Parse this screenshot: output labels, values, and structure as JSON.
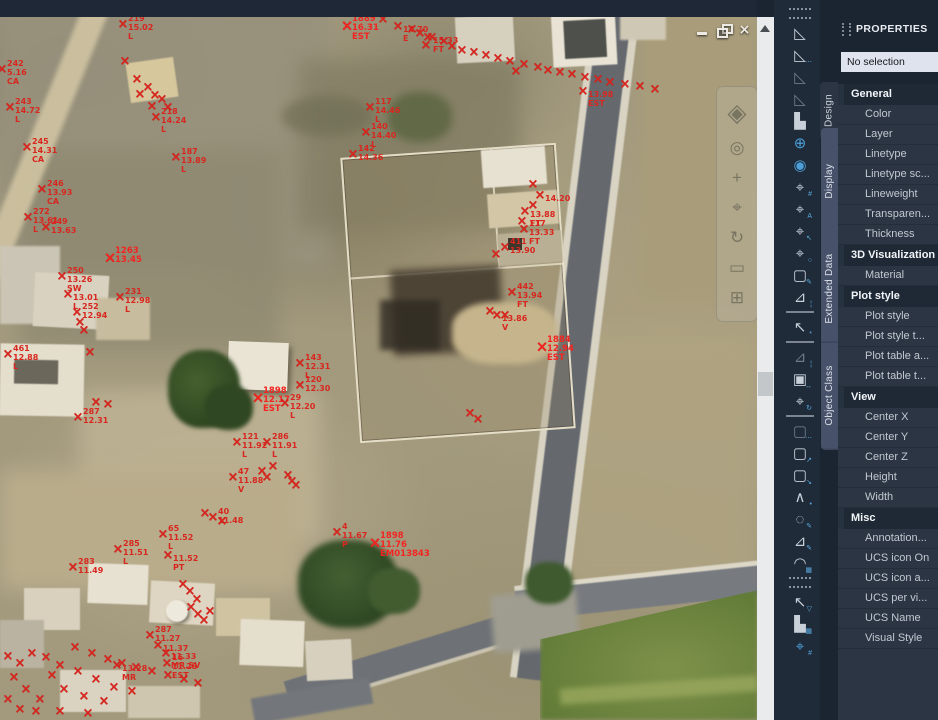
{
  "window": {
    "controls": [
      {
        "name": "minimize"
      },
      {
        "name": "restore"
      },
      {
        "name": "close"
      }
    ]
  },
  "nav_bar": {
    "icons": [
      {
        "name": "viewcube-icon",
        "glyph": "◈"
      },
      {
        "name": "steering-wheel-icon",
        "glyph": "◎"
      },
      {
        "name": "pan-icon",
        "glyph": "+"
      },
      {
        "name": "zoom-icon",
        "glyph": "⌖"
      },
      {
        "name": "orbit-icon",
        "glyph": "↻"
      },
      {
        "name": "showmotion-icon",
        "glyph": "▭"
      },
      {
        "name": "layout-grid-icon",
        "glyph": "⊞"
      }
    ]
  },
  "side_toolbar": {
    "items": [
      {
        "type": "grip"
      },
      {
        "name": "surface-triangle-icon",
        "glyph": "◺"
      },
      {
        "name": "surface-dashed-icon",
        "glyph": "◺",
        "sub": "⋯"
      },
      {
        "name": "surface-dim-icon",
        "glyph": "◺",
        "c": "dim"
      },
      {
        "name": "surface-outline-icon",
        "glyph": "◺",
        "c": "dim"
      },
      {
        "name": "blocks-icon",
        "glyph": "▙"
      },
      {
        "name": "globe-grid-icon",
        "glyph": "⊕",
        "c": "blue"
      },
      {
        "name": "blue-sphere-icon",
        "glyph": "◉",
        "c": "blue"
      },
      {
        "name": "point-hash-icon",
        "glyph": "⌖",
        "sub": "#"
      },
      {
        "name": "point-label-icon",
        "glyph": "⌖",
        "sub": "A"
      },
      {
        "name": "point-cursor-icon",
        "glyph": "⌖",
        "sub": "↖"
      },
      {
        "name": "point-zoom-icon",
        "glyph": "⌖",
        "sub": "○"
      },
      {
        "name": "edit-box-icon",
        "glyph": "▢",
        "sub": "✎"
      },
      {
        "name": "profile-dashed-icon",
        "glyph": "⊿",
        "sub": "¦"
      },
      {
        "type": "sep"
      },
      {
        "name": "selection-cursor-icon",
        "glyph": "↖",
        "sub": "*"
      },
      {
        "type": "sep"
      },
      {
        "name": "dashed-view-icon",
        "glyph": "⊿",
        "c": "dim",
        "sub": "¦"
      },
      {
        "name": "box-3d-icon",
        "glyph": "▣",
        "sub": "↔"
      },
      {
        "name": "point-rotate-icon",
        "glyph": "⌖",
        "sub": "↻"
      },
      {
        "type": "sep"
      },
      {
        "name": "dashed-rect-icon",
        "glyph": "▢",
        "c": "dim",
        "sub": "⋯"
      },
      {
        "name": "stretch-rect-icon",
        "glyph": "▢",
        "sub": "↗"
      },
      {
        "name": "scale-rect-icon",
        "glyph": "▢",
        "sub": "↘"
      },
      {
        "name": "polyline-nodes-icon",
        "glyph": "∧",
        "sub": "•"
      },
      {
        "name": "circle-modify-icon",
        "glyph": "◌",
        "sub": "✎"
      },
      {
        "name": "triangle-modify-icon",
        "glyph": "⊿",
        "sub": "✎"
      },
      {
        "name": "arc-calc-icon",
        "glyph": "◠",
        "sub": "▦"
      },
      {
        "type": "grip"
      },
      {
        "name": "filter-cursor-icon",
        "glyph": "↖",
        "sub": "▽"
      },
      {
        "name": "blocks-grid-icon",
        "glyph": "▙",
        "sub": "▦"
      },
      {
        "name": "point-filter-icon",
        "glyph": "⌖",
        "c": "blue",
        "sub": "#"
      }
    ]
  },
  "properties_panel": {
    "title": "PROPERTIES",
    "selection": "No selection",
    "tabs": [
      {
        "label": "Design",
        "active": true
      },
      {
        "label": "Display",
        "active": false
      },
      {
        "label": "Extended Data",
        "active": false
      },
      {
        "label": "Object Class",
        "active": false
      }
    ],
    "sections": [
      {
        "header": "General",
        "rows": [
          "Color",
          "Layer",
          "Linetype",
          "Linetype sc...",
          "Lineweight",
          "Transparen...",
          "Thickness"
        ]
      },
      {
        "header": "3D Visualization",
        "rows": [
          "Material"
        ]
      },
      {
        "header": "Plot style",
        "rows": [
          "Plot style",
          "Plot style t...",
          "Plot table a...",
          "Plot table t..."
        ]
      },
      {
        "header": "View",
        "rows": [
          "Center X",
          "Center Y",
          "Center Z",
          "Height",
          "Width"
        ]
      },
      {
        "header": "Misc",
        "rows": [
          "Annotation...",
          "UCS icon On",
          "UCS icon a...",
          "UCS per vi...",
          "UCS Name",
          "Visual Style"
        ]
      }
    ]
  },
  "map": {
    "x_glyph": "×",
    "marker_color": "#da241e",
    "bold_color": "#f42420",
    "markers": [
      {
        "x": 123,
        "y": 25,
        "t": [
          "219",
          "15.02",
          "L"
        ]
      },
      {
        "x": 347,
        "y": 26,
        "t": [
          "1889",
          "16.31",
          "EST"
        ],
        "b": 1
      },
      {
        "x": 398,
        "y": 27,
        "t": [
          "",
          "14.70",
          "E"
        ]
      },
      {
        "x": 428,
        "y": 38,
        "t": [
          "",
          "15.33",
          "FT"
        ]
      },
      {
        "x": 583,
        "y": 92,
        "t": [
          "",
          "13.98",
          "EST"
        ]
      },
      {
        "x": 2,
        "y": 70,
        "t": [
          "242",
          "5.16",
          "CA"
        ]
      },
      {
        "x": 10,
        "y": 108,
        "t": [
          "243",
          "14.72",
          "L"
        ]
      },
      {
        "x": 156,
        "y": 118,
        "t": [
          "218",
          "14.24",
          "L"
        ]
      },
      {
        "x": 27,
        "y": 148,
        "t": [
          "245",
          "14.31",
          "CA"
        ]
      },
      {
        "x": 176,
        "y": 158,
        "t": [
          "187",
          "13.89",
          "L"
        ]
      },
      {
        "x": 42,
        "y": 190,
        "t": [
          "246",
          "13.93",
          "CA"
        ]
      },
      {
        "x": 28,
        "y": 218,
        "t": [
          "272",
          "13.61",
          "L"
        ]
      },
      {
        "x": 46,
        "y": 228,
        "t": [
          "249",
          "13.63"
        ]
      },
      {
        "x": 110,
        "y": 258,
        "t": [
          "1263",
          "13.45"
        ],
        "b": 1
      },
      {
        "x": 62,
        "y": 277,
        "t": [
          "250",
          "13.26",
          "SW"
        ]
      },
      {
        "x": 68,
        "y": 295,
        "t": [
          "",
          "13.01",
          "L"
        ]
      },
      {
        "x": 120,
        "y": 298,
        "t": [
          "231",
          "12.98",
          "L"
        ]
      },
      {
        "x": 77,
        "y": 313,
        "t": [
          "252",
          "12.94"
        ]
      },
      {
        "x": 8,
        "y": 355,
        "t": [
          "461",
          "12.88",
          "L"
        ]
      },
      {
        "x": 78,
        "y": 418,
        "t": [
          "287",
          "12.31"
        ]
      },
      {
        "x": 370,
        "y": 108,
        "t": [
          "117",
          "14.46",
          "L"
        ]
      },
      {
        "x": 366,
        "y": 133,
        "t": [
          "140",
          "14.40",
          "L"
        ]
      },
      {
        "x": 353,
        "y": 155,
        "t": [
          "142",
          "14.36"
        ]
      },
      {
        "x": 540,
        "y": 196,
        "t": [
          "",
          "14.20"
        ]
      },
      {
        "x": 525,
        "y": 212,
        "t": [
          "",
          "13.88",
          "FT"
        ]
      },
      {
        "x": 524,
        "y": 230,
        "t": [
          "117",
          "13.33",
          "FT"
        ]
      },
      {
        "x": 505,
        "y": 248,
        "t": [
          "411",
          "13.90"
        ]
      },
      {
        "x": 512,
        "y": 293,
        "t": [
          "442",
          "13.94",
          "FT"
        ]
      },
      {
        "x": 497,
        "y": 316,
        "t": [
          "",
          "13.86",
          "V"
        ]
      },
      {
        "x": 542,
        "y": 347,
        "t": [
          "1884",
          "12.94",
          "EST"
        ],
        "b": 1
      },
      {
        "x": 300,
        "y": 364,
        "t": [
          "143",
          "12.31",
          "L"
        ]
      },
      {
        "x": 300,
        "y": 386,
        "t": [
          "120",
          "12.30"
        ]
      },
      {
        "x": 258,
        "y": 398,
        "t": [
          "1898",
          "12.17",
          "EST"
        ],
        "b": 1
      },
      {
        "x": 285,
        "y": 404,
        "t": [
          "29",
          "12.20",
          "L"
        ]
      },
      {
        "x": 237,
        "y": 443,
        "t": [
          "121",
          "11.92",
          "L"
        ]
      },
      {
        "x": 267,
        "y": 443,
        "t": [
          "286",
          "11.91",
          "L"
        ]
      },
      {
        "x": 233,
        "y": 478,
        "t": [
          "47",
          "11.88",
          "V"
        ]
      },
      {
        "x": 213,
        "y": 518,
        "t": [
          "40",
          "11.48"
        ]
      },
      {
        "x": 163,
        "y": 535,
        "t": [
          "65",
          "11.52",
          "L"
        ]
      },
      {
        "x": 118,
        "y": 550,
        "t": [
          "285",
          "11.51",
          "L"
        ]
      },
      {
        "x": 168,
        "y": 556,
        "t": [
          "",
          "11.52",
          "PT"
        ]
      },
      {
        "x": 73,
        "y": 568,
        "t": [
          "283",
          "11.49"
        ]
      },
      {
        "x": 337,
        "y": 533,
        "t": [
          "4",
          "11.67",
          "P"
        ]
      },
      {
        "x": 375,
        "y": 543,
        "t": [
          "1898",
          "11.76",
          "EM013843"
        ],
        "b": 1
      },
      {
        "x": 150,
        "y": 636,
        "t": [
          "287",
          "11.27"
        ]
      },
      {
        "x": 158,
        "y": 646,
        "t": [
          "",
          "11.37"
        ]
      },
      {
        "x": 166,
        "y": 654,
        "t": [
          "",
          "11.33",
          "MR.SV"
        ]
      },
      {
        "x": 117,
        "y": 666,
        "t": [
          "",
          "13.28",
          "MR"
        ]
      },
      {
        "x": 167,
        "y": 664,
        "t": [
          "16",
          "11.28",
          "EST"
        ]
      }
    ],
    "points": [
      [
        125,
        62
      ],
      [
        137,
        80
      ],
      [
        148,
        88
      ],
      [
        140,
        95
      ],
      [
        155,
        96
      ],
      [
        162,
        100
      ],
      [
        152,
        107
      ],
      [
        168,
        108
      ],
      [
        383,
        20
      ],
      [
        412,
        30
      ],
      [
        420,
        34
      ],
      [
        432,
        38
      ],
      [
        444,
        42
      ],
      [
        426,
        46
      ],
      [
        452,
        47
      ],
      [
        462,
        51
      ],
      [
        474,
        53
      ],
      [
        486,
        56
      ],
      [
        498,
        59
      ],
      [
        510,
        62
      ],
      [
        524,
        65
      ],
      [
        538,
        68
      ],
      [
        516,
        72
      ],
      [
        548,
        71
      ],
      [
        560,
        73
      ],
      [
        572,
        75
      ],
      [
        585,
        78
      ],
      [
        598,
        80
      ],
      [
        610,
        83
      ],
      [
        625,
        85
      ],
      [
        640,
        87
      ],
      [
        655,
        90
      ],
      [
        448,
        4
      ],
      [
        457,
        10
      ],
      [
        533,
        185
      ],
      [
        533,
        206
      ],
      [
        522,
        222
      ],
      [
        496,
        255
      ],
      [
        490,
        312
      ],
      [
        505,
        316
      ],
      [
        80,
        323
      ],
      [
        84,
        331
      ],
      [
        90,
        353
      ],
      [
        96,
        403
      ],
      [
        108,
        405
      ],
      [
        470,
        414
      ],
      [
        478,
        420
      ],
      [
        262,
        472
      ],
      [
        273,
        467
      ],
      [
        267,
        478
      ],
      [
        288,
        476
      ],
      [
        292,
        482
      ],
      [
        296,
        486
      ],
      [
        205,
        514
      ],
      [
        222,
        522
      ],
      [
        183,
        585
      ],
      [
        190,
        592
      ],
      [
        197,
        600
      ],
      [
        191,
        608
      ],
      [
        198,
        615
      ],
      [
        204,
        621
      ],
      [
        210,
        612
      ],
      [
        75,
        648
      ],
      [
        92,
        654
      ],
      [
        108,
        660
      ],
      [
        122,
        664
      ],
      [
        136,
        668
      ],
      [
        152,
        672
      ],
      [
        168,
        676
      ],
      [
        184,
        680
      ],
      [
        198,
        684
      ],
      [
        60,
        666
      ],
      [
        78,
        672
      ],
      [
        96,
        680
      ],
      [
        114,
        688
      ],
      [
        132,
        692
      ],
      [
        64,
        690
      ],
      [
        84,
        697
      ],
      [
        104,
        702
      ],
      [
        46,
        658
      ],
      [
        32,
        654
      ],
      [
        52,
        676
      ],
      [
        20,
        664
      ],
      [
        8,
        657
      ],
      [
        14,
        678
      ],
      [
        26,
        690
      ],
      [
        8,
        700
      ],
      [
        40,
        700
      ],
      [
        20,
        710
      ],
      [
        36,
        712
      ],
      [
        60,
        712
      ],
      [
        88,
        714
      ]
    ]
  }
}
